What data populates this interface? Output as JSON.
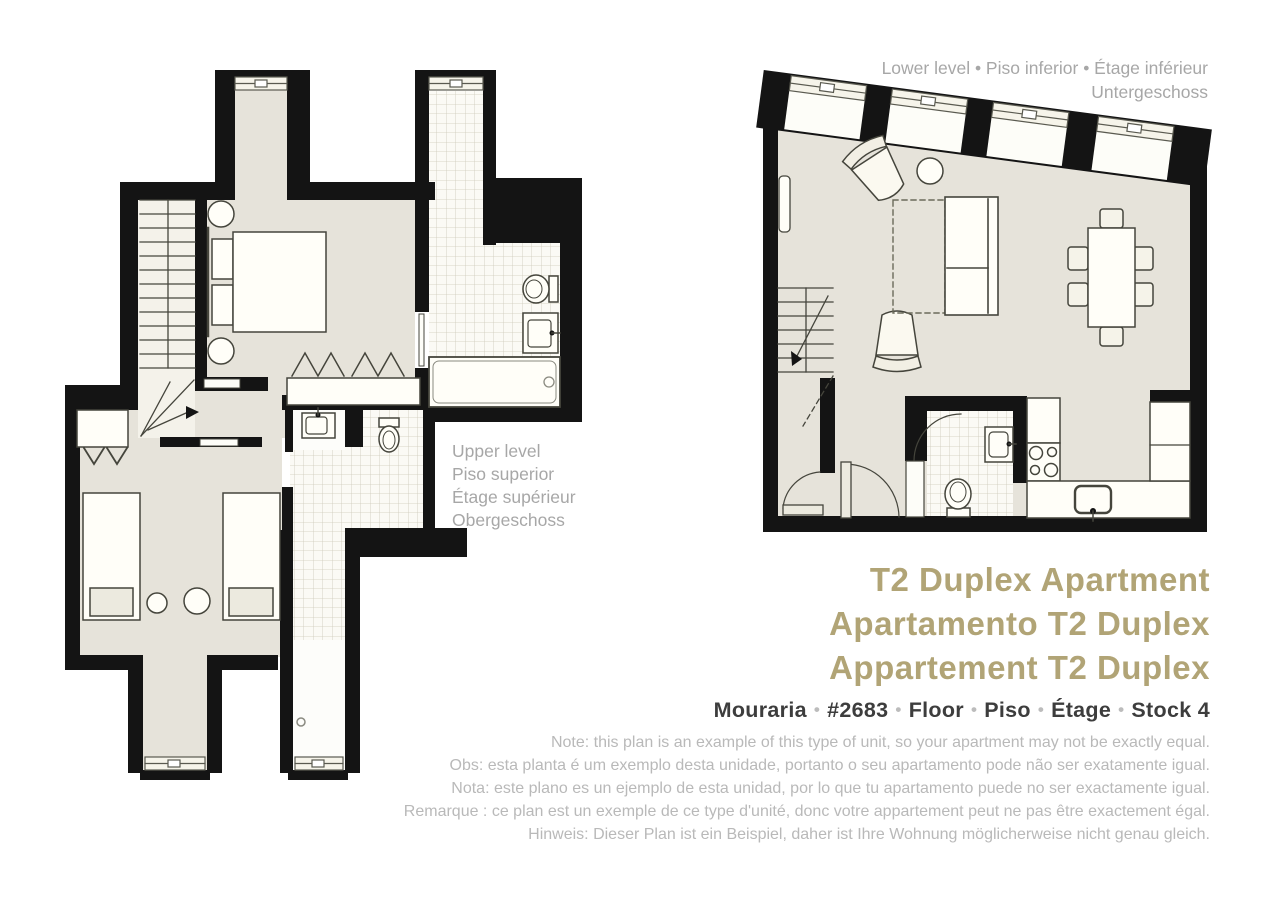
{
  "plans": {
    "lower": {
      "label_line1": "Lower level • Piso inferior • Étage inférieur",
      "label_line2": "Untergeschoss"
    },
    "upper": {
      "label_lines": [
        "Upper level",
        "Piso superior",
        "Étage supérieur",
        "Obergeschoss"
      ]
    }
  },
  "titles": [
    "T2 Duplex Apartment",
    "Apartamento T2 Duplex",
    "Appartement T2 Duplex"
  ],
  "location": {
    "parts": [
      "Mouraria",
      "#2683",
      "Floor",
      "Piso",
      "Étage",
      "Stock 4"
    ],
    "separator": "•"
  },
  "notes": [
    "Note: this plan is an example of this type of unit, so your apartment may not be exactly equal.",
    "Obs: esta planta é um exemplo desta unidade, portanto o seu apartamento pode não ser exatamente igual.",
    "Nota: este plano es un ejemplo de esta unidad, por lo que tu apartamento puede no ser exactamente igual.",
    "Remarque : ce plan est un exemple de ce type d'unité, donc votre appartement peut ne pas être exactement égal.",
    "Hinweis: Dieser Plan ist ein Beispiel, daher ist Ihre Wohnung möglicherweise nicht genau gleich."
  ],
  "colors": {
    "wall": "#141414",
    "floor": "#e6e3da",
    "tile_bg": "#fbfaf5",
    "tile_line": "#cdc9ba",
    "furniture_stroke": "#45453c",
    "title_gold": "#b1a476",
    "label_gray": "#a7a7a7",
    "note_gray": "#b9b9b9",
    "location_dark": "#3d3d3d"
  }
}
